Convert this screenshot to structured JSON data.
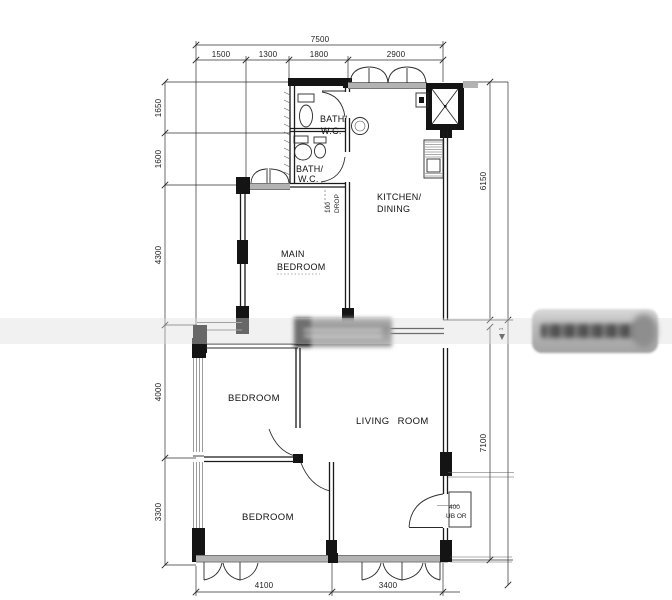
{
  "figure": {
    "type": "floor-plan"
  },
  "dims": {
    "top_total": "7500",
    "top": [
      "1500",
      "1300",
      "1800",
      "2900"
    ],
    "left": [
      "1650",
      "1600",
      "4300",
      "4000",
      "3300"
    ],
    "right_upper": "6150",
    "right_lower": "7100",
    "right_step": "1",
    "bottom": [
      "4100",
      "3400"
    ]
  },
  "rooms": {
    "bath_top": [
      "BATH/",
      "W.C."
    ],
    "bath_mid": [
      "BATH/",
      "W.C."
    ],
    "kitchen": [
      "KITCHEN/",
      "DINING"
    ],
    "main_bedroom": [
      "MAIN",
      "BEDROOM"
    ],
    "bedroom_mid": "BEDROOM",
    "bedroom_bottom": "BEDROOM",
    "living_room": "LIVING ROOM"
  },
  "notes": {
    "drop": [
      "100",
      "DROP"
    ],
    "ledge": [
      "400",
      "UB OR"
    ]
  },
  "colors": {
    "ink": "#1a1a1a",
    "wall": "#141414",
    "window_band": "#b3b3b3",
    "watermark": "#b5b5b5"
  }
}
